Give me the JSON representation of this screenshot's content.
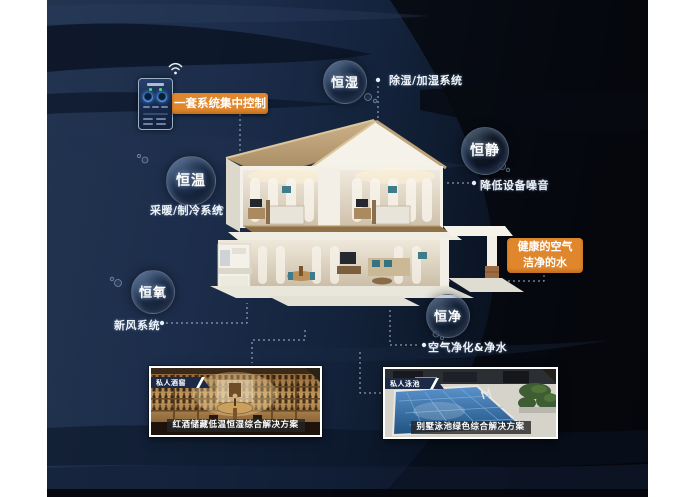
{
  "bubbles": [
    {
      "id": "humidity",
      "label": "恒湿"
    },
    {
      "id": "quiet",
      "label": "恒静"
    },
    {
      "id": "temperature",
      "label": "恒温"
    },
    {
      "id": "oxygen",
      "label": "恒氧"
    },
    {
      "id": "purity",
      "label": "恒净"
    }
  ],
  "callouts": {
    "humidity": "除湿/加湿系统",
    "quiet": "降低设备噪音",
    "temperature": "采暖/制冷系统",
    "oxygen": "新风系统",
    "purity": "空气净化&净水"
  },
  "control": {
    "badge": "一套系统集中控制"
  },
  "highlight": {
    "line1": "健康的空气",
    "line2": "洁净的水"
  },
  "cards": {
    "wine": {
      "tag": "私人酒窖",
      "caption": "红酒储藏低温恒湿综合解决方案"
    },
    "pool": {
      "tag": "私人泳池",
      "caption": "别墅泳池绿色综合解决方案"
    }
  },
  "colors": {
    "accent_orange": "#e0862c",
    "canvas_navy": "#1d2f4f",
    "canvas_dark": "#05080d",
    "label_white": "#eef3f9"
  }
}
